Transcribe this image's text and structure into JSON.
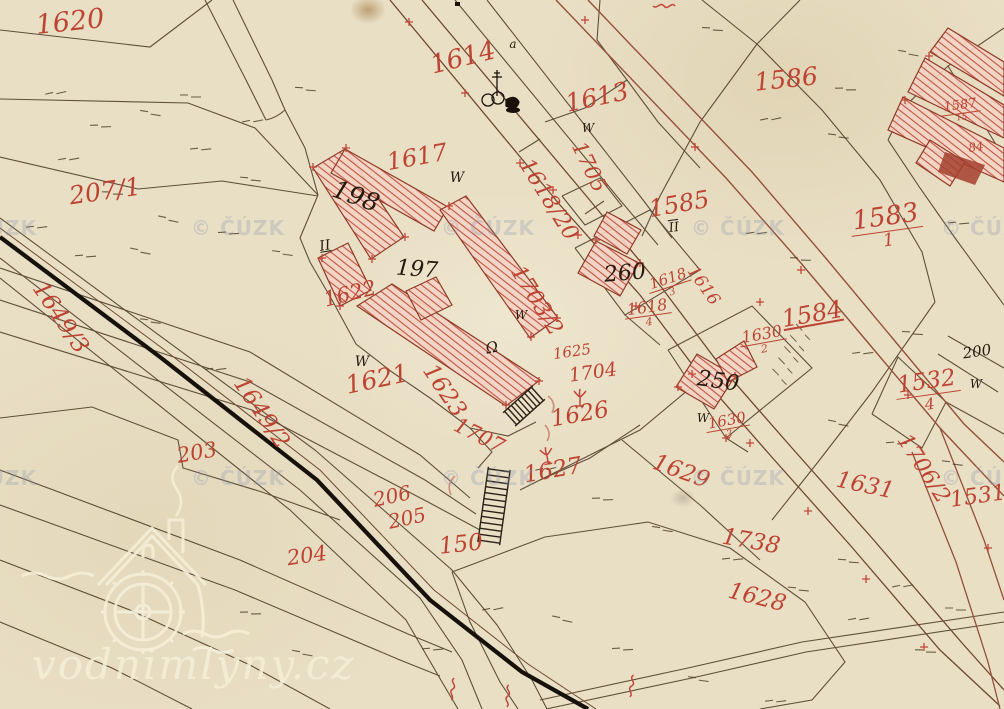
{
  "map": {
    "type": "historical cadastral map scan",
    "colors": {
      "paper": "#e9dfc5",
      "boundary_ink": "#4d3b27",
      "parcel_number_red": "#bd4433",
      "building_fill": "#f3d4c6",
      "building_hatch": "#bf5540",
      "stream_ink": "#17110b",
      "road_sienna": "#95503a",
      "cuzk_watermark": "#8e99af",
      "logo_watermark": "#f6efd9"
    },
    "red_labels": [
      {
        "t": "1620",
        "x": 70,
        "y": 22,
        "r": -6,
        "s": 27
      },
      {
        "t": "207/1",
        "x": 105,
        "y": 191,
        "r": -8,
        "s": 25
      },
      {
        "t": "1614",
        "x": 463,
        "y": 58,
        "r": -14,
        "s": 26
      },
      {
        "t": "1613",
        "x": 597,
        "y": 97,
        "r": -12,
        "s": 25
      },
      {
        "t": "1586",
        "x": 786,
        "y": 79,
        "r": -6,
        "s": 25
      },
      {
        "t": "1617",
        "x": 417,
        "y": 157,
        "r": -10,
        "s": 24
      },
      {
        "t": "1705",
        "x": 589,
        "y": 167,
        "r": 64,
        "s": 21
      },
      {
        "t": "1618/20",
        "x": 548,
        "y": 200,
        "r": 58,
        "s": 22
      },
      {
        "t": "1585",
        "x": 679,
        "y": 204,
        "r": -10,
        "s": 24
      },
      {
        "t": "1583",
        "den": "1",
        "x": 887,
        "y": 228,
        "r": -8,
        "s": 26
      },
      {
        "t": "1584",
        "x": 812,
        "y": 314,
        "r": -10,
        "s": 24,
        "u": 1
      },
      {
        "t": "1703/2",
        "x": 536,
        "y": 301,
        "r": 58,
        "s": 22
      },
      {
        "t": "1616",
        "x": 703,
        "y": 286,
        "r": 55,
        "s": 17
      },
      {
        "t": "1618",
        "den": "3",
        "x": 670,
        "y": 285,
        "r": -18,
        "s": 15
      },
      {
        "t": "1618",
        "den": "4",
        "x": 648,
        "y": 314,
        "r": -8,
        "s": 16
      },
      {
        "t": "1630",
        "den": "2",
        "x": 763,
        "y": 341,
        "r": -10,
        "s": 16
      },
      {
        "t": "1630",
        "den": "3",
        "x": 728,
        "y": 427,
        "r": -10,
        "s": 15
      },
      {
        "t": "1532",
        "den": "4",
        "x": 928,
        "y": 392,
        "r": -8,
        "s": 23
      },
      {
        "t": "1587",
        "den": "15",
        "x": 961,
        "y": 112,
        "r": -8,
        "s": 13
      },
      {
        "t": "84",
        "x": 976,
        "y": 147,
        "r": -8,
        "s": 12
      },
      {
        "t": "1649/3",
        "x": 60,
        "y": 318,
        "r": 56,
        "s": 23
      },
      {
        "t": "1649/2",
        "x": 261,
        "y": 413,
        "r": 56,
        "s": 23
      },
      {
        "t": "203",
        "x": 197,
        "y": 453,
        "r": -10,
        "s": 21
      },
      {
        "t": "206",
        "x": 392,
        "y": 496,
        "r": -12,
        "s": 20
      },
      {
        "t": "205",
        "x": 407,
        "y": 518,
        "r": -12,
        "s": 20
      },
      {
        "t": "204",
        "x": 307,
        "y": 556,
        "r": -8,
        "s": 21
      },
      {
        "t": "150",
        "x": 461,
        "y": 545,
        "r": -6,
        "s": 23
      },
      {
        "t": "1621",
        "x": 377,
        "y": 379,
        "r": -12,
        "s": 25
      },
      {
        "t": "1623",
        "x": 444,
        "y": 391,
        "r": 56,
        "s": 23
      },
      {
        "t": "1622",
        "x": 350,
        "y": 294,
        "r": -14,
        "s": 21
      },
      {
        "t": "1625",
        "x": 572,
        "y": 352,
        "r": -8,
        "s": 15
      },
      {
        "t": "1704",
        "x": 593,
        "y": 373,
        "r": -8,
        "s": 19
      },
      {
        "t": "1626",
        "x": 580,
        "y": 415,
        "r": -10,
        "s": 23
      },
      {
        "t": "1627",
        "x": 553,
        "y": 471,
        "r": -10,
        "s": 23
      },
      {
        "t": "1707",
        "x": 479,
        "y": 436,
        "r": 27,
        "s": 21
      },
      {
        "t": "1629",
        "x": 681,
        "y": 472,
        "r": 20,
        "s": 23
      },
      {
        "t": "1631",
        "x": 865,
        "y": 486,
        "r": 12,
        "s": 23
      },
      {
        "t": "1706/2",
        "x": 923,
        "y": 469,
        "r": 57,
        "s": 22
      },
      {
        "t": "1531",
        "x": 978,
        "y": 497,
        "r": -8,
        "s": 22
      },
      {
        "t": "1738",
        "x": 751,
        "y": 542,
        "r": 10,
        "s": 23
      },
      {
        "t": "1628",
        "x": 757,
        "y": 598,
        "r": 14,
        "s": 23
      }
    ],
    "black_labels": [
      {
        "t": "198",
        "x": 356,
        "y": 196,
        "r": 20,
        "s": 25
      },
      {
        "t": "197",
        "x": 417,
        "y": 270,
        "r": 4,
        "s": 22
      },
      {
        "t": "260",
        "x": 625,
        "y": 274,
        "r": -5,
        "s": 22
      },
      {
        "t": "250",
        "x": 718,
        "y": 382,
        "r": 8,
        "s": 22
      },
      {
        "t": "200",
        "x": 977,
        "y": 352,
        "r": -8,
        "s": 15
      },
      {
        "t": "II",
        "x": 325,
        "y": 246,
        "r": -10,
        "s": 14,
        "u": 1
      },
      {
        "t": "II",
        "x": 674,
        "y": 228,
        "r": -8,
        "s": 13,
        "o": 1
      },
      {
        "t": "W",
        "x": 457,
        "y": 178,
        "r": 0,
        "s": 14
      },
      {
        "t": "W",
        "x": 588,
        "y": 128,
        "r": 0,
        "s": 12
      },
      {
        "t": "W",
        "x": 362,
        "y": 362,
        "r": 0,
        "s": 14
      },
      {
        "t": "W",
        "x": 521,
        "y": 315,
        "r": 0,
        "s": 12
      },
      {
        "t": "W",
        "x": 703,
        "y": 418,
        "r": 0,
        "s": 12
      },
      {
        "t": "W",
        "x": 976,
        "y": 384,
        "r": 0,
        "s": 12
      },
      {
        "t": "a",
        "x": 513,
        "y": 44,
        "r": 0,
        "s": 12
      },
      {
        "t": "Ω",
        "x": 492,
        "y": 348,
        "r": -12,
        "s": 15
      }
    ],
    "watermark": {
      "text": "© ČÚZK",
      "positions": [
        [
          -10,
          228
        ],
        [
          238,
          228
        ],
        [
          488,
          228
        ],
        [
          738,
          228
        ],
        [
          988,
          228
        ],
        [
          -10,
          478
        ],
        [
          238,
          478
        ],
        [
          488,
          478
        ],
        [
          738,
          478
        ],
        [
          988,
          478
        ]
      ]
    },
    "logo": {
      "text": "vodnimlyny.cz"
    }
  }
}
